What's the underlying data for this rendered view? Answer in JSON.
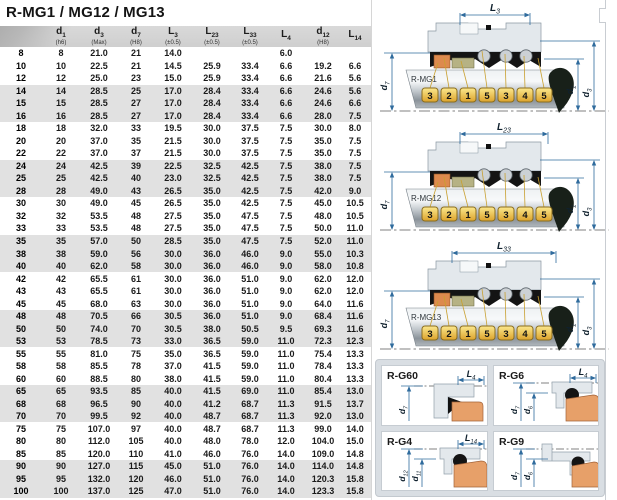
{
  "title": "R-MG1 / MG12 / MG13",
  "colors": {
    "dim_line": "#2f6b9d",
    "tag_gold_light": "#fbe88d",
    "tag_gold_dark": "#dca32b",
    "tag_border": "#8a6d1f",
    "seat_orange": "#e7a069",
    "part_orange": "#dd8a4e",
    "part_olive": "#b6b284",
    "elastomer_black": "#141414",
    "gland_gray": "#e3e8ec",
    "row_shade": "#e1e1e1",
    "panel_bg": "#d9dee3"
  },
  "table": {
    "columns": [
      {
        "main": "",
        "sub": "",
        "note": ""
      },
      {
        "main": "d",
        "sub": "1",
        "note": "(h6)"
      },
      {
        "main": "d",
        "sub": "3",
        "note": "(Max)"
      },
      {
        "main": "d",
        "sub": "7",
        "note": "(H8)"
      },
      {
        "main": "L",
        "sub": "3",
        "note": "(±0.5)"
      },
      {
        "main": "L",
        "sub": "23",
        "note": "(±0.5)"
      },
      {
        "main": "L",
        "sub": "33",
        "note": "(±0.5)"
      },
      {
        "main": "L",
        "sub": "4",
        "note": ""
      },
      {
        "main": "d",
        "sub": "12",
        "note": "(H8)"
      },
      {
        "main": "L",
        "sub": "14",
        "note": ""
      }
    ],
    "rows": [
      {
        "size": "8",
        "values": [
          "8",
          "21.0",
          "21",
          "14.0",
          "",
          "",
          "6.0",
          "",
          ""
        ]
      },
      {
        "size": "10",
        "values": [
          "10",
          "22.5",
          "21",
          "14.5",
          "25.9",
          "33.4",
          "6.6",
          "19.2",
          "6.6"
        ]
      },
      {
        "size": "12",
        "values": [
          "12",
          "25.0",
          "23",
          "15.0",
          "25.9",
          "33.4",
          "6.6",
          "21.6",
          "5.6"
        ]
      },
      {
        "size": "14",
        "values": [
          "14",
          "28.5",
          "25",
          "17.0",
          "28.4",
          "33.4",
          "6.6",
          "24.6",
          "5.6"
        ]
      },
      {
        "size": "15",
        "values": [
          "15",
          "28.5",
          "27",
          "17.0",
          "28.4",
          "33.4",
          "6.6",
          "24.6",
          "6.6"
        ]
      },
      {
        "size": "16",
        "values": [
          "16",
          "28.5",
          "27",
          "17.0",
          "28.4",
          "33.4",
          "6.6",
          "28.0",
          "7.5"
        ]
      },
      {
        "size": "18",
        "values": [
          "18",
          "32.0",
          "33",
          "19.5",
          "30.0",
          "37.5",
          "7.5",
          "30.0",
          "8.0"
        ]
      },
      {
        "size": "20",
        "values": [
          "20",
          "37.0",
          "35",
          "21.5",
          "30.0",
          "37.5",
          "7.5",
          "35.0",
          "7.5"
        ]
      },
      {
        "size": "22",
        "values": [
          "22",
          "37.0",
          "37",
          "21.5",
          "30.0",
          "37.5",
          "7.5",
          "35.0",
          "7.5"
        ]
      },
      {
        "size": "24",
        "values": [
          "24",
          "42.5",
          "39",
          "22.5",
          "32.5",
          "42.5",
          "7.5",
          "38.0",
          "7.5"
        ]
      },
      {
        "size": "25",
        "values": [
          "25",
          "42.5",
          "40",
          "23.0",
          "32.5",
          "42.5",
          "7.5",
          "38.0",
          "7.5"
        ]
      },
      {
        "size": "28",
        "values": [
          "28",
          "49.0",
          "43",
          "26.5",
          "35.0",
          "42.5",
          "7.5",
          "42.0",
          "9.0"
        ]
      },
      {
        "size": "30",
        "values": [
          "30",
          "49.0",
          "45",
          "26.5",
          "35.0",
          "42.5",
          "7.5",
          "45.0",
          "10.5"
        ]
      },
      {
        "size": "32",
        "values": [
          "32",
          "53.5",
          "48",
          "27.5",
          "35.0",
          "47.5",
          "7.5",
          "48.0",
          "10.5"
        ]
      },
      {
        "size": "33",
        "values": [
          "33",
          "53.5",
          "48",
          "27.5",
          "35.0",
          "47.5",
          "7.5",
          "50.0",
          "11.0"
        ]
      },
      {
        "size": "35",
        "values": [
          "35",
          "57.0",
          "50",
          "28.5",
          "35.0",
          "47.5",
          "7.5",
          "52.0",
          "11.0"
        ]
      },
      {
        "size": "38",
        "values": [
          "38",
          "59.0",
          "56",
          "30.0",
          "36.0",
          "46.0",
          "9.0",
          "55.0",
          "10.3"
        ]
      },
      {
        "size": "40",
        "values": [
          "40",
          "62.0",
          "58",
          "30.0",
          "36.0",
          "46.0",
          "9.0",
          "58.0",
          "10.8"
        ]
      },
      {
        "size": "42",
        "values": [
          "42",
          "65.5",
          "61",
          "30.0",
          "36.0",
          "51.0",
          "9.0",
          "62.0",
          "12.0"
        ]
      },
      {
        "size": "43",
        "values": [
          "43",
          "65.5",
          "61",
          "30.0",
          "36.0",
          "51.0",
          "9.0",
          "62.0",
          "12.0"
        ]
      },
      {
        "size": "45",
        "values": [
          "45",
          "68.0",
          "63",
          "30.0",
          "36.0",
          "51.0",
          "9.0",
          "64.0",
          "11.6"
        ]
      },
      {
        "size": "48",
        "values": [
          "48",
          "70.5",
          "66",
          "30.5",
          "36.0",
          "51.0",
          "9.0",
          "68.4",
          "11.6"
        ]
      },
      {
        "size": "50",
        "values": [
          "50",
          "74.0",
          "70",
          "30.5",
          "38.0",
          "50.5",
          "9.5",
          "69.3",
          "11.6"
        ]
      },
      {
        "size": "53",
        "values": [
          "53",
          "78.5",
          "73",
          "33.0",
          "36.5",
          "59.0",
          "11.0",
          "72.3",
          "12.3"
        ]
      },
      {
        "size": "55",
        "values": [
          "55",
          "81.0",
          "75",
          "35.0",
          "36.5",
          "59.0",
          "11.0",
          "75.4",
          "13.3"
        ]
      },
      {
        "size": "58",
        "values": [
          "58",
          "85.5",
          "78",
          "37.0",
          "41.5",
          "59.0",
          "11.0",
          "78.4",
          "13.3"
        ]
      },
      {
        "size": "60",
        "values": [
          "60",
          "88.5",
          "80",
          "38.0",
          "41.5",
          "59.0",
          "11.0",
          "80.4",
          "13.3"
        ]
      },
      {
        "size": "65",
        "values": [
          "65",
          "93.5",
          "85",
          "40.0",
          "41.5",
          "69.0",
          "11.0",
          "85.4",
          "13.0"
        ]
      },
      {
        "size": "68",
        "values": [
          "68",
          "96.5",
          "90",
          "40.0",
          "41.2",
          "68.7",
          "11.3",
          "91.5",
          "13.7"
        ]
      },
      {
        "size": "70",
        "values": [
          "70",
          "99.5",
          "92",
          "40.0",
          "48.7",
          "68.7",
          "11.3",
          "92.0",
          "13.0"
        ]
      },
      {
        "size": "75",
        "values": [
          "75",
          "107.0",
          "97",
          "40.0",
          "48.7",
          "68.7",
          "11.3",
          "99.0",
          "14.0"
        ]
      },
      {
        "size": "80",
        "values": [
          "80",
          "112.0",
          "105",
          "40.0",
          "48.0",
          "78.0",
          "12.0",
          "104.0",
          "15.0"
        ]
      },
      {
        "size": "85",
        "values": [
          "85",
          "120.0",
          "110",
          "41.0",
          "46.0",
          "76.0",
          "14.0",
          "109.0",
          "14.8"
        ]
      },
      {
        "size": "90",
        "values": [
          "90",
          "127.0",
          "115",
          "45.0",
          "51.0",
          "76.0",
          "14.0",
          "114.0",
          "14.8"
        ]
      },
      {
        "size": "95",
        "values": [
          "95",
          "132.0",
          "120",
          "46.0",
          "51.0",
          "76.0",
          "14.0",
          "120.3",
          "15.8"
        ]
      },
      {
        "size": "100",
        "values": [
          "100",
          "137.0",
          "125",
          "47.0",
          "51.0",
          "76.0",
          "14.0",
          "123.3",
          "15.8"
        ]
      }
    ]
  },
  "diagrams": [
    {
      "label": "R-MG1",
      "dim": {
        "main": "L",
        "sub": "3"
      },
      "left_label": {
        "main": "d",
        "sub": "7"
      },
      "right_labels": [
        {
          "main": "d",
          "sub": "1"
        },
        {
          "main": "d",
          "sub": "3"
        }
      ],
      "tags": [
        "3",
        "2",
        "1",
        "5",
        "3",
        "4",
        "5"
      ],
      "span": [
        88,
        158
      ]
    },
    {
      "label": "R-MG12",
      "dim": {
        "main": "L",
        "sub": "23"
      },
      "left_label": {
        "main": "d",
        "sub": "7"
      },
      "right_labels": [
        {
          "main": "d",
          "sub": "1"
        },
        {
          "main": "d",
          "sub": "3"
        }
      ],
      "tags": [
        "3",
        "2",
        "1",
        "5",
        "3",
        "4",
        "5"
      ],
      "span": [
        88,
        176
      ]
    },
    {
      "label": "R-MG13",
      "dim": {
        "main": "L",
        "sub": "33"
      },
      "left_label": {
        "main": "d",
        "sub": "7"
      },
      "right_labels": [
        {
          "main": "d",
          "sub": "1"
        },
        {
          "main": "d",
          "sub": "3"
        }
      ],
      "tags": [
        "3",
        "2",
        "1",
        "5",
        "3",
        "4",
        "5"
      ],
      "span": [
        80,
        184
      ]
    }
  ],
  "detail_panels": [
    {
      "title": "R-G60",
      "dim": {
        "main": "L",
        "sub": "4"
      },
      "left_labels": [
        {
          "main": "d",
          "sub": "7"
        }
      ],
      "variant": "g60"
    },
    {
      "title": "R-G6",
      "dim": {
        "main": "L",
        "sub": "4"
      },
      "left_labels": [
        {
          "main": "d",
          "sub": "7"
        },
        {
          "main": "d",
          "sub": "6"
        }
      ],
      "variant": "g6"
    },
    {
      "title": "R-G4",
      "dim": {
        "main": "L",
        "sub": "14"
      },
      "left_labels": [
        {
          "main": "d",
          "sub": "12"
        },
        {
          "main": "d",
          "sub": "11"
        }
      ],
      "variant": "g4"
    },
    {
      "title": "R-G9",
      "dim": null,
      "left_labels": [
        {
          "main": "d",
          "sub": "7"
        },
        {
          "main": "d",
          "sub": "6"
        }
      ],
      "variant": "g9"
    }
  ]
}
